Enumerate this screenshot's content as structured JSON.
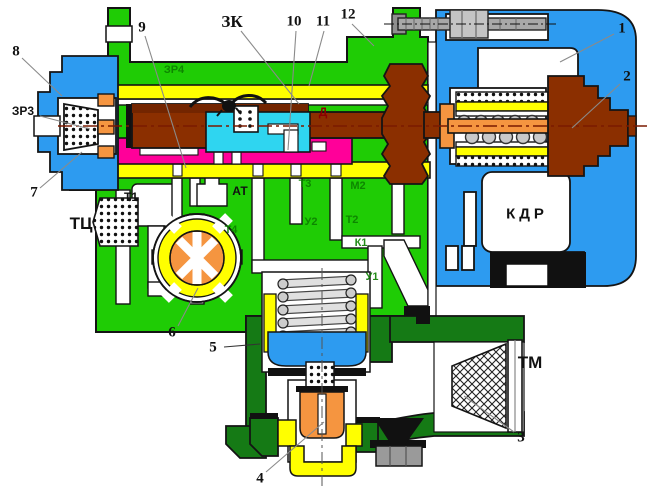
{
  "diagram": {
    "description": "Cross-section schematic of a railway air distributor valve",
    "colors": {
      "body_green": "#1fcc05",
      "dark_green": "#157a15",
      "housing_blue": "#2d9bf0",
      "gasket_yellow": "#ffff00",
      "piston_brown": "#8b2f00",
      "piston_brown_dark": "#732500",
      "chamber_magenta": "#ff0099",
      "chamber_cyan": "#2fd5f0",
      "valve_orange": "#f59540",
      "metal_gray": "#a8a8a8",
      "nut_gray": "#c4c4c4",
      "outline": "#141414",
      "leader": "#8a8a8a",
      "port_label_green": "#0c7f00",
      "label_dark_red": "#8b0000",
      "centerline_red": "#7a1a00"
    },
    "labels": [
      {
        "id": "n8",
        "text": "8",
        "x": 16,
        "y": 52,
        "cls": "num"
      },
      {
        "id": "n9",
        "text": "9",
        "x": 142,
        "y": 28,
        "cls": "num"
      },
      {
        "id": "zk",
        "text": "ЗК",
        "x": 232,
        "y": 22,
        "cls": "zk"
      },
      {
        "id": "n10",
        "text": "10",
        "x": 294,
        "y": 22,
        "cls": "num"
      },
      {
        "id": "n11",
        "text": "11",
        "x": 323,
        "y": 22,
        "cls": "num"
      },
      {
        "id": "n12",
        "text": "12",
        "x": 348,
        "y": 15,
        "cls": "num"
      },
      {
        "id": "n1",
        "text": "1",
        "x": 622,
        "y": 29,
        "cls": "num"
      },
      {
        "id": "n2",
        "text": "2",
        "x": 627,
        "y": 77,
        "cls": "num"
      },
      {
        "id": "zr3",
        "text": "ЗР3",
        "x": 23,
        "y": 111,
        "cls": "small"
      },
      {
        "id": "zr4",
        "text": "ЗР4",
        "x": 174,
        "y": 70,
        "cls": "green"
      },
      {
        "id": "n7",
        "text": "7",
        "x": 34,
        "y": 193,
        "cls": "num"
      },
      {
        "id": "tc",
        "text": "ТЦ",
        "x": 81,
        "y": 224,
        "cls": "big"
      },
      {
        "id": "t1",
        "text": "Т1",
        "x": 131,
        "y": 197,
        "cls": "small"
      },
      {
        "id": "at",
        "text": "АТ",
        "x": 240,
        "y": 191,
        "cls": "small"
      },
      {
        "id": "d",
        "text": "Д",
        "x": 323,
        "y": 112,
        "cls": "red"
      },
      {
        "id": "t3",
        "text": "Т3",
        "x": 305,
        "y": 184,
        "cls": "green"
      },
      {
        "id": "m2",
        "text": "М2",
        "x": 358,
        "y": 186,
        "cls": "green"
      },
      {
        "id": "u2",
        "text": "У2",
        "x": 311,
        "y": 222,
        "cls": "green"
      },
      {
        "id": "t2",
        "text": "Т2",
        "x": 352,
        "y": 220,
        "cls": "green"
      },
      {
        "id": "t4",
        "text": "Т4",
        "x": 231,
        "y": 230,
        "cls": "green"
      },
      {
        "id": "k1",
        "text": "К1",
        "x": 361,
        "y": 243,
        "cls": "green"
      },
      {
        "id": "u1",
        "text": "У1",
        "x": 372,
        "y": 277,
        "cls": "green"
      },
      {
        "id": "kdr",
        "text": "КДР",
        "x": 527,
        "y": 214,
        "cls": "kdr"
      },
      {
        "id": "tm",
        "text": "ТМ",
        "x": 530,
        "y": 363,
        "cls": "big"
      },
      {
        "id": "n6",
        "text": "6",
        "x": 172,
        "y": 333,
        "cls": "num"
      },
      {
        "id": "n5",
        "text": "5",
        "x": 213,
        "y": 348,
        "cls": "num"
      },
      {
        "id": "n4",
        "text": "4",
        "x": 260,
        "y": 479,
        "cls": "num"
      },
      {
        "id": "n3",
        "text": "3",
        "x": 521,
        "y": 438,
        "cls": "num"
      }
    ]
  }
}
